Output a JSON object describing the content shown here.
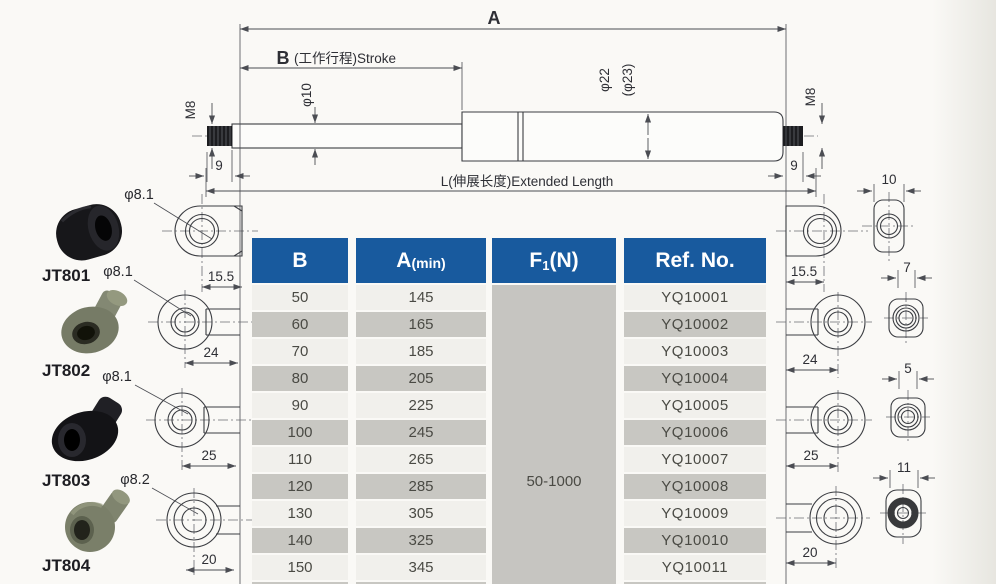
{
  "colors": {
    "header_blue": "#185a9e",
    "row_light": "#f1f0ec",
    "row_dark": "#c8c7c2",
    "line": "#3b3d42"
  },
  "drawing": {
    "dim_a": "A",
    "dim_b_letter": "B",
    "dim_b_rest": "(工作行程)Stroke",
    "dim_l": "L(伸展长度)Extended Length",
    "rod_dia": "φ10",
    "tube_dia": "φ22",
    "tube_dia_alt": "(φ23)",
    "thread_left": "M8",
    "thread_right": "M8",
    "thread_len_left": "9",
    "thread_len_right": "9"
  },
  "fittings": {
    "left": [
      {
        "model": "JT801",
        "hole_dia": "φ8.1",
        "dim": "15.5"
      },
      {
        "model": "JT802",
        "hole_dia": "φ8.1",
        "dim": "24"
      },
      {
        "model": "JT803",
        "hole_dia": "φ8.1",
        "dim": "25"
      },
      {
        "model": "JT804",
        "hole_dia": "φ8.2",
        "dim": "20"
      }
    ],
    "right": [
      {
        "dim": "15.5",
        "end_dim": "10"
      },
      {
        "dim": "24",
        "end_dim": "7"
      },
      {
        "dim": "25",
        "end_dim": "5"
      },
      {
        "dim": "20",
        "end_dim": "11"
      }
    ]
  },
  "table": {
    "headers": {
      "b": "B",
      "a_main": "A",
      "a_note": "(min)",
      "f_main": "F",
      "f_sub": "1",
      "f_note": "(N)",
      "ref": "Ref. No."
    },
    "force_range": "50-1000",
    "rows": [
      {
        "b": "50",
        "a": "145",
        "ref": "YQ10001"
      },
      {
        "b": "60",
        "a": "165",
        "ref": "YQ10002"
      },
      {
        "b": "70",
        "a": "185",
        "ref": "YQ10003"
      },
      {
        "b": "80",
        "a": "205",
        "ref": "YQ10004"
      },
      {
        "b": "90",
        "a": "225",
        "ref": "YQ10005"
      },
      {
        "b": "100",
        "a": "245",
        "ref": "YQ10006"
      },
      {
        "b": "110",
        "a": "265",
        "ref": "YQ10007"
      },
      {
        "b": "120",
        "a": "285",
        "ref": "YQ10008"
      },
      {
        "b": "130",
        "a": "305",
        "ref": "YQ10009"
      },
      {
        "b": "140",
        "a": "325",
        "ref": "YQ10010"
      },
      {
        "b": "150",
        "a": "345",
        "ref": "YQ10011"
      }
    ]
  }
}
